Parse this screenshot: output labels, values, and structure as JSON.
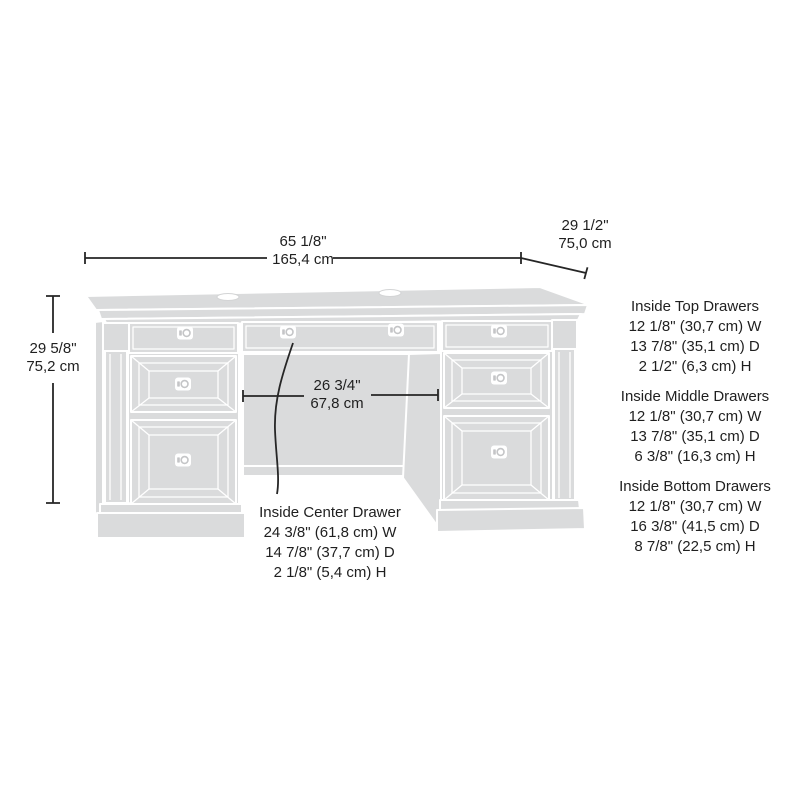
{
  "dimensions": {
    "width": {
      "in": "65 1/8\"",
      "cm": "165,4 cm"
    },
    "depth": {
      "in": "29 1/2\"",
      "cm": "75,0 cm"
    },
    "height": {
      "in": "29 5/8\"",
      "cm": "75,2 cm"
    },
    "kneehole": {
      "in": "26 3/4\"",
      "cm": "67,8 cm"
    }
  },
  "center_drawer": {
    "title": "Inside Center Drawer",
    "w": "24 3/8\" (61,8 cm) W",
    "d": "14 7/8\" (37,7 cm) D",
    "h": "2 1/8\" (5,4 cm) H"
  },
  "drawer_specs": [
    {
      "title": "Inside Top Drawers",
      "w": "12 1/8\" (30,7 cm) W",
      "d": "13 7/8\" (35,1 cm) D",
      "h": "2 1/2\" (6,3 cm) H"
    },
    {
      "title": "Inside Middle Drawers",
      "w": "12 1/8\" (30,7 cm) W",
      "d": "13 7/8\" (35,1 cm) D",
      "h": "6 3/8\" (16,3 cm) H"
    },
    {
      "title": "Inside Bottom Drawers",
      "w": "12 1/8\" (30,7 cm) W",
      "d": "16 3/8\" (41,5 cm) D",
      "h": "8 7/8\" (22,5 cm) H"
    }
  ],
  "colors": {
    "artwork_fill": "#dadbdc",
    "artwork_line": "#ffffff",
    "dimension_ink": "#262626",
    "background": "#ffffff"
  }
}
